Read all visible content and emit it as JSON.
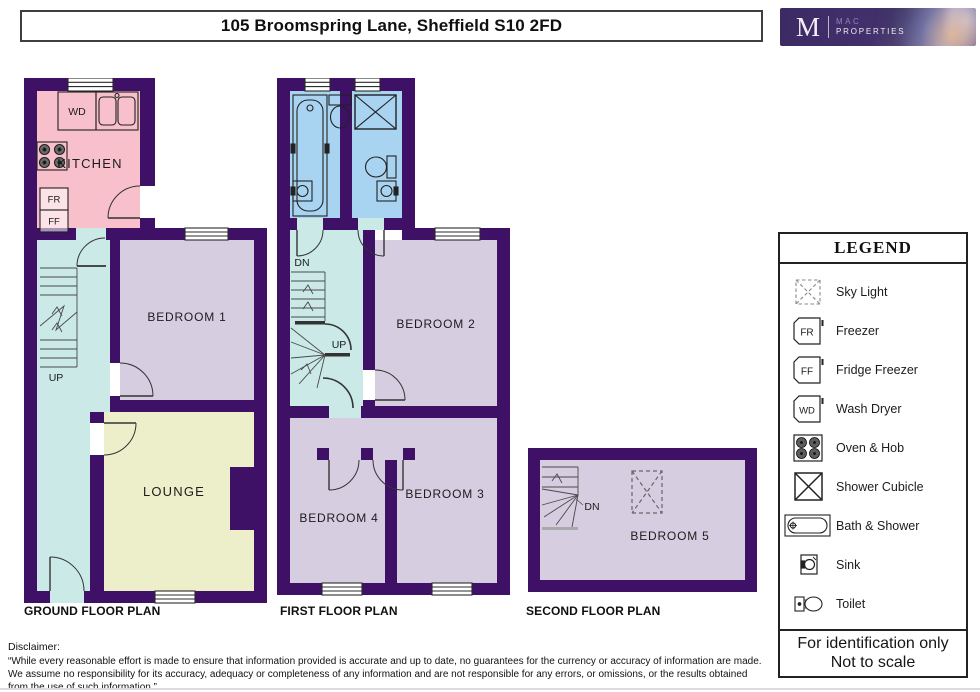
{
  "header": {
    "title": "105 Broomspring Lane, Sheffield S10 2FD",
    "logo": {
      "monogram": "M",
      "name_line1": "MAC",
      "name_line2": "PROPERTIES"
    }
  },
  "plans": {
    "ground": {
      "label": "GROUND FLOOR PLAN",
      "rooms": {
        "kitchen": "KITCHEN",
        "bedroom1": "BEDROOM 1",
        "lounge": "LOUNGE"
      },
      "annotations": {
        "up": "UP",
        "wash_dryer": "WD",
        "freezer": "FR",
        "fridge_freezer": "FF"
      }
    },
    "first": {
      "label": "FIRST FLOOR PLAN",
      "rooms": {
        "bedroom2": "BEDROOM 2",
        "bedroom3": "BEDROOM 3",
        "bedroom4": "BEDROOM 4"
      },
      "annotations": {
        "dn": "DN",
        "up": "UP"
      }
    },
    "second": {
      "label": "SECOND FLOOR PLAN",
      "rooms": {
        "bedroom5": "BEDROOM 5"
      },
      "annotations": {
        "dn": "DN"
      }
    }
  },
  "legend": {
    "title": "LEGEND",
    "items": [
      {
        "icon": "sky-light-icon",
        "label": "Sky Light"
      },
      {
        "icon": "freezer-icon",
        "abbr": "FR",
        "label": "Freezer"
      },
      {
        "icon": "fridge-freezer-icon",
        "abbr": "FF",
        "label": "Fridge Freezer"
      },
      {
        "icon": "wash-dryer-icon",
        "abbr": "WD",
        "label": "Wash Dryer"
      },
      {
        "icon": "oven-hob-icon",
        "label": "Oven & Hob"
      },
      {
        "icon": "shower-cubicle-icon",
        "label": "Shower Cubicle"
      },
      {
        "icon": "bath-shower-icon",
        "label": "Bath & Shower"
      },
      {
        "icon": "sink-icon",
        "label": "Sink"
      },
      {
        "icon": "toilet-icon",
        "label": "Toilet"
      }
    ],
    "footer": {
      "line1": "For identification only",
      "line2": "Not to scale"
    }
  },
  "disclaimer": {
    "heading": "Disclaimer:",
    "body": "“While every reasonable effort is made to ensure that information provided is accurate and up to date, no guarantees for the currency or accuracy of information are made. We assume no responsibility for its accuracy, adequacy or completeness of any information and are not responsible for any errors, or omissions, or the results obtained from the use of such information.”"
  },
  "colors": {
    "wall": "#3E1166",
    "kitchen": "#F8C0CB",
    "hall": "#CBE9E6",
    "bedroom": "#D7CDE1",
    "lounge": "#EDEECA",
    "bathroom": "#A9D4F1"
  }
}
